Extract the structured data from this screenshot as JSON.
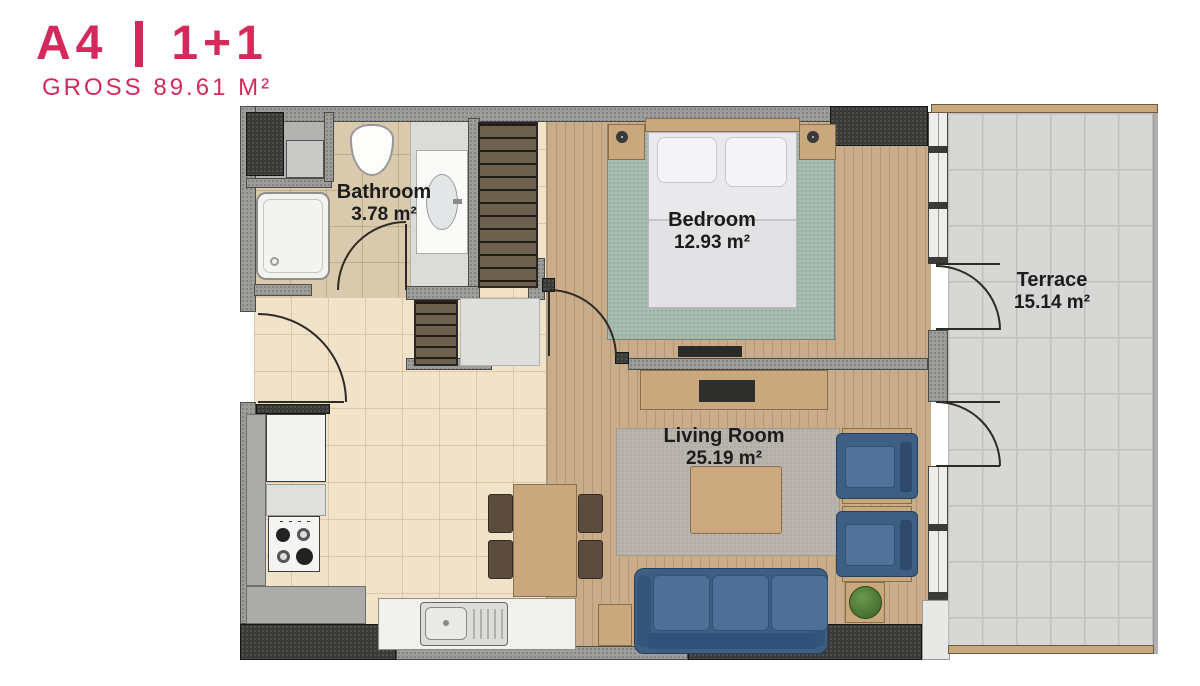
{
  "header": {
    "unit": "A4",
    "divider": "|",
    "plan_type": "1+1",
    "gross": "GROSS 89.61 M²"
  },
  "rooms": {
    "bathroom": {
      "name": "Bathroom",
      "area": "3.78 m²"
    },
    "bedroom": {
      "name": "Bedroom",
      "area": "12.93 m²"
    },
    "living_room": {
      "name": "Living Room",
      "area": "25.19 m²"
    },
    "terrace": {
      "name": "Terrace",
      "area": "15.14 m²"
    }
  },
  "colors": {
    "accent": "#D4295B",
    "wall": "#9D9D9B",
    "wall_dark": "#3A3A38",
    "floor_tile": "#F0E3CA",
    "floor_bath": "#DACAAD",
    "floor_wood": "#C9AD8B",
    "carpet": "#A7BBB1",
    "terrace_tile": "#D7D7D5",
    "sofa": "#3E5F83",
    "rug": "#B9B5AD",
    "furniture_wood": "#C8A87C",
    "label": "#1C1C1C"
  }
}
